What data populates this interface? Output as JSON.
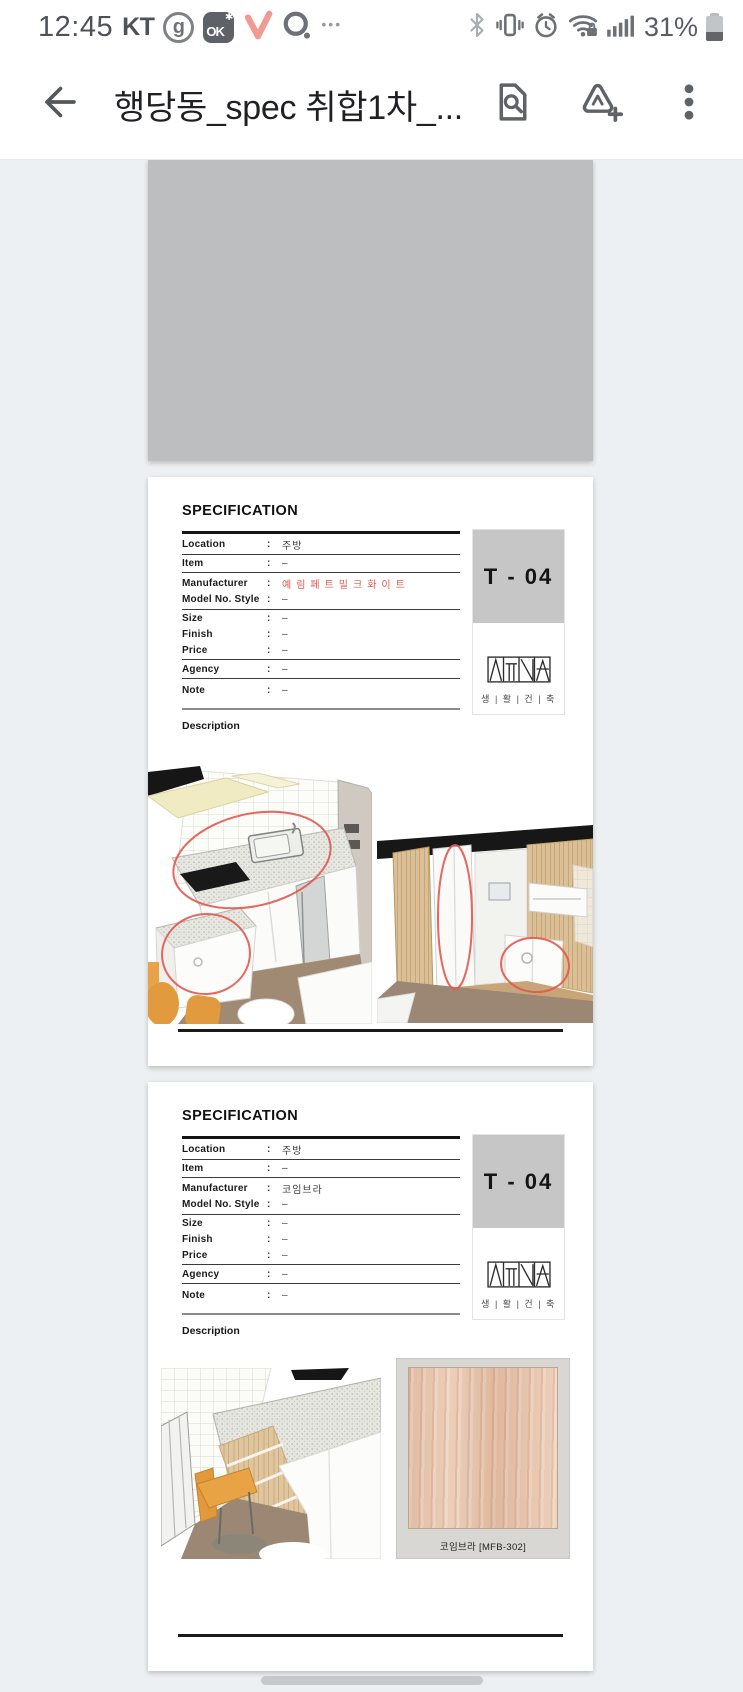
{
  "colors": {
    "accent_red": "#e4574f",
    "annotation_red": "#e2574e",
    "viewer_background": "#edf0f2",
    "placeholder_gray": "#bdbec0",
    "code_box_gray": "#c5c6c5",
    "toolbar_icon_gray": "#5f6368",
    "orange_chair": "#e29a3e",
    "floor_brown": "#9c8774"
  },
  "status_bar": {
    "time": "12:45",
    "carrier": "KT",
    "ok_badge": "OK",
    "ok_star": "✱",
    "more_dots": "•••",
    "battery_percent": "31%",
    "left_icons": [
      "g-app-icon",
      "ok-app-icon",
      "pink-check-app-icon",
      "o-app-icon",
      "more-notifications-icon"
    ],
    "right_icons": [
      "bluetooth-icon",
      "vibrate-icon",
      "alarm-icon",
      "wifi-secured-icon",
      "signal-strength-icon",
      "battery-icon"
    ]
  },
  "app_bar": {
    "title": "행당동_spec 취합1차_...",
    "icons": [
      "back-arrow-icon",
      "find-in-document-icon",
      "annotate-add-icon",
      "overflow-menu-icon"
    ]
  },
  "document": {
    "colon": ":",
    "pages": [
      {
        "type": "placeholder-image"
      },
      {
        "type": "spec-sheet",
        "heading": "SPECIFICATION",
        "code": "T - 04",
        "logo_caption": "생 | 활 | 건 | 축",
        "description_label": "Description",
        "rows": [
          {
            "label": "Location",
            "value": "주방"
          },
          {
            "label": "Item",
            "value": "–"
          },
          {
            "label": "Manufacturer",
            "value": "예림페트밀크화이트",
            "red": true
          },
          {
            "label": "Model No. Style",
            "value": "–"
          },
          {
            "label": "Size",
            "value": "–"
          },
          {
            "label": "Finish",
            "value": "–"
          },
          {
            "label": "Price",
            "value": "–"
          },
          {
            "label": "Agency",
            "value": "–"
          },
          {
            "label": "Note",
            "value": "–"
          }
        ],
        "figures": [
          "kitchen-render-annotated",
          "pantry-render-annotated"
        ]
      },
      {
        "type": "spec-sheet",
        "heading": "SPECIFICATION",
        "code": "T - 04",
        "logo_caption": "생 | 활 | 건 | 축",
        "description_label": "Description",
        "rows": [
          {
            "label": "Location",
            "value": "주방"
          },
          {
            "label": "Item",
            "value": "–"
          },
          {
            "label": "Manufacturer",
            "value": "코임브라"
          },
          {
            "label": "Model No. Style",
            "value": "–"
          },
          {
            "label": "Size",
            "value": "–"
          },
          {
            "label": "Finish",
            "value": "–"
          },
          {
            "label": "Price",
            "value": "–"
          },
          {
            "label": "Agency",
            "value": "–"
          },
          {
            "label": "Note",
            "value": "–"
          }
        ],
        "sample_label": "코임브라 [MFB-302]",
        "figures": [
          "kitchen-corner-render",
          "wood-film-sample"
        ]
      }
    ]
  },
  "navigation": {
    "gesture_pill": "home-gesture-pill"
  }
}
